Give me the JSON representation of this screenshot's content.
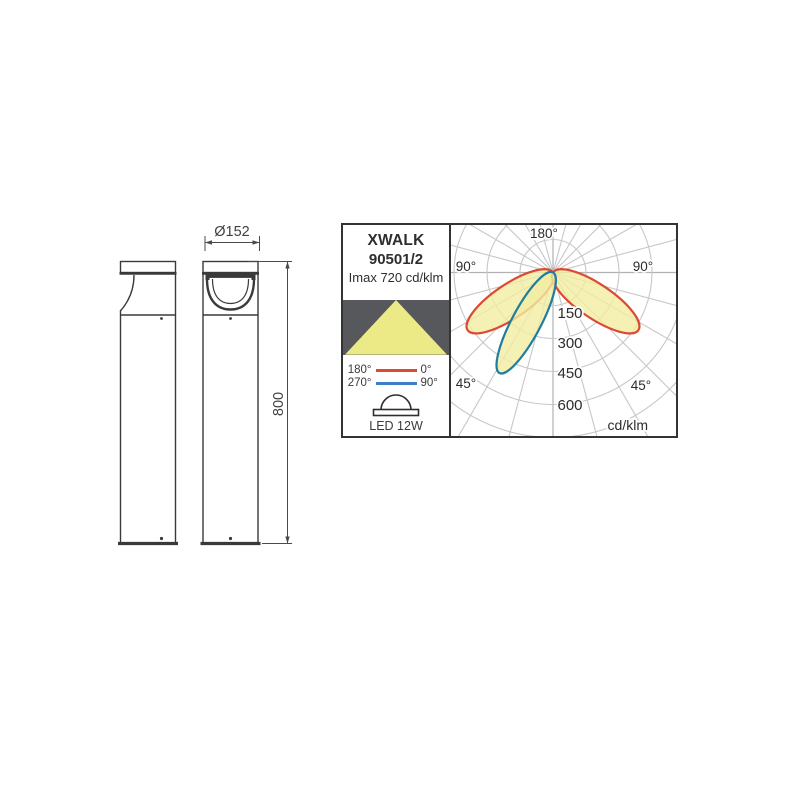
{
  "product": {
    "name": "XWALK",
    "code": "90501/2",
    "imax_label": "Imax 720 cd/klm",
    "lamp_label": "LED 12W"
  },
  "dimensions": {
    "diameter_label": "Ø152",
    "height_label": "800"
  },
  "legend": {
    "rows": [
      {
        "left": "180°",
        "right": "0°",
        "color": "#dc4a34"
      },
      {
        "left": "270°",
        "right": "90°",
        "color": "#3a80c2"
      }
    ]
  },
  "icons": {
    "beam_box_color": "#57585c",
    "beam_triangle_color": "#ece987"
  },
  "chart_data": {
    "type": "polar",
    "subtype": "photometric-intensity-distribution",
    "units_label": "cd/klm",
    "imax_cd_klm": 720,
    "ring_values": [
      150,
      300,
      450,
      600
    ],
    "ring_step": 150,
    "grid": {
      "angle_step_deg": 15,
      "on": true
    },
    "angle_labels": {
      "top": "180°",
      "left_upper": "90°",
      "right_upper": "90°",
      "left_lower": "45°",
      "right_lower": "45°"
    },
    "series": [
      {
        "name": "C0–C180 plane (legend 180°–0°)",
        "color": "#dc4a34",
        "lobes": [
          {
            "peak_angle_from_nadir_deg": -56,
            "peak_intensity_cd_klm": 480
          },
          {
            "peak_angle_from_nadir_deg": 56,
            "peak_intensity_cd_klm": 480
          }
        ]
      },
      {
        "name": "C90–C270 plane (legend 270°–90°)",
        "color": "#1f7d9e",
        "lobes": [
          {
            "peak_angle_from_nadir_deg": -29,
            "peak_intensity_cd_klm": 530
          }
        ]
      }
    ],
    "lobe_fill_color": "#f2eea2"
  }
}
